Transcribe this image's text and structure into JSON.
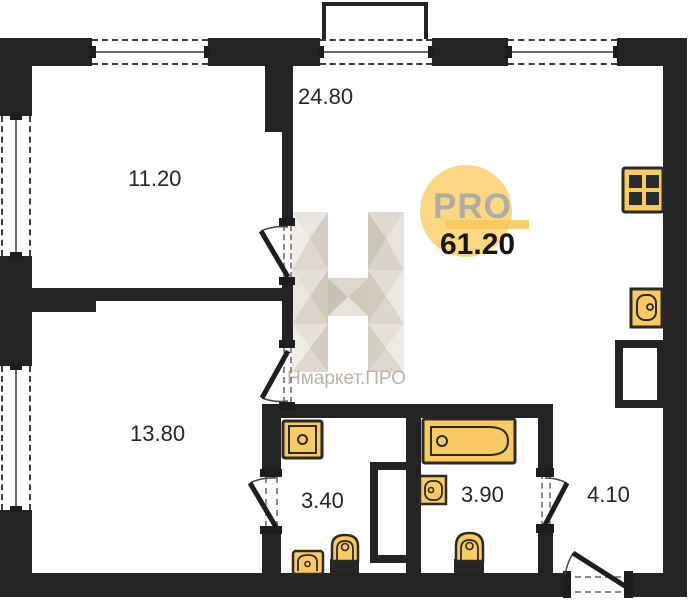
{
  "floor_plan": {
    "logo": {
      "text": "PRO",
      "total_area": "61.20"
    },
    "watermark": {
      "brand": "Нмаркет.ПРО"
    },
    "rooms": [
      {
        "id": "living-kitchen",
        "area": "24.80"
      },
      {
        "id": "room-upper",
        "area": "11.20"
      },
      {
        "id": "room-lower",
        "area": "13.80"
      },
      {
        "id": "wc-small",
        "area": "3.40"
      },
      {
        "id": "bathroom",
        "area": "3.90"
      },
      {
        "id": "hallway",
        "area": "4.10"
      }
    ],
    "fixtures": {
      "kitchen": [
        "stove-icon",
        "kitchen-sink-icon"
      ],
      "wc_small": [
        "washing-machine-icon",
        "hand-sink-icon",
        "toilet-icon"
      ],
      "bathroom": [
        "bathtub-icon",
        "wall-sink-icon",
        "toilet-icon"
      ]
    },
    "colors": {
      "wall": "#232323",
      "fixture_fill": "#f8ca66",
      "fixture_stroke": "#2d2a24",
      "logo_circle": "#fbd784",
      "logo_underline": "#f7c85e",
      "logo_text": "#b0aba3",
      "watermark_text": "#b7b3ac",
      "room_label": "#262626",
      "h_facet_light": "#ece8e2",
      "h_facet_mid": "#dcd6cd",
      "h_facet_dark": "#c9c2b6"
    }
  }
}
